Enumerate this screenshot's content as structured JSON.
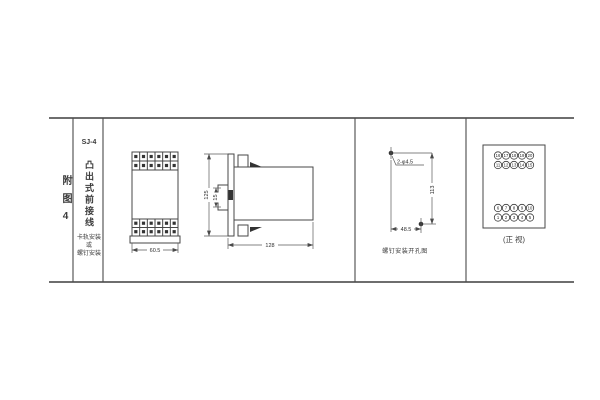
{
  "page": {
    "background": "#ffffff",
    "ink_color": "#3f3f3f"
  },
  "figure_index": {
    "label": "附图4"
  },
  "model_column": {
    "model": "SJ-4",
    "wiring_type": "凸出式前接线",
    "mount_line1": "卡轨安装",
    "mount_line2": "或",
    "mount_line3": "螺钉安装"
  },
  "front_view": {
    "width_dim": "60.5",
    "terminal_cols": 6
  },
  "side_view": {
    "height_dim": "125",
    "clip_dim": "15",
    "depth_dim": "128"
  },
  "drill_view": {
    "holes_label": "2-φ4.5",
    "vertical_dim": "113",
    "horizontal_dim": "48.5",
    "caption": "螺钉安装开孔图"
  },
  "terminal_view": {
    "caption": "(正 视)",
    "rows": [
      [
        "16",
        "17",
        "18",
        "19",
        "20"
      ],
      [
        "11",
        "12",
        "13",
        "14",
        "15"
      ],
      [
        "6",
        "7",
        "8",
        "9",
        "10"
      ],
      [
        "1",
        "2",
        "3",
        "4",
        "5"
      ]
    ]
  }
}
